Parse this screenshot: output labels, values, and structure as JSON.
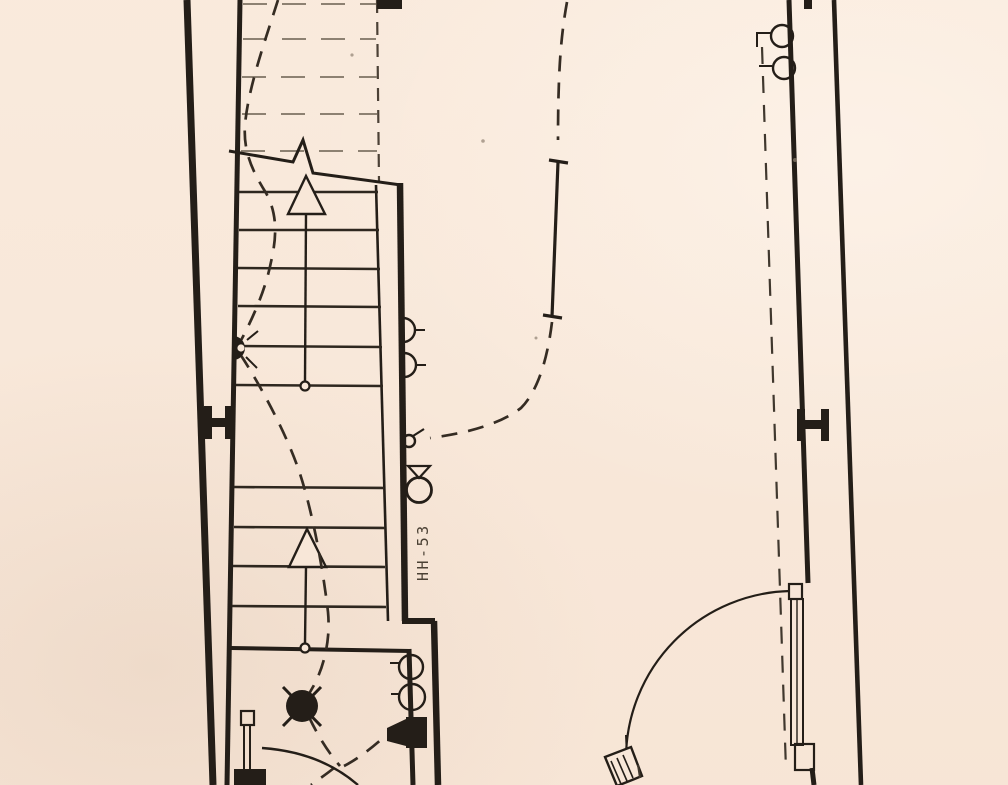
{
  "plan": {
    "kind": "scanned electrical floor plan - stairwell section",
    "riser_label": "HH-53",
    "colors": {
      "paper": "#f8e7d8",
      "ink": "#241e18",
      "faded_tread": "#8d8172",
      "wiring_dash": "#352c23",
      "label_ink": "#4a4034"
    },
    "symbols": [
      "stair-up-arrow",
      "stair-break-line",
      "wall-sconce-light",
      "crossed-ceiling-light",
      "wall-projector-fixture",
      "duplex-outlet",
      "junction-circle",
      "detector-circle-with-triangle",
      "steel-column-ibeam",
      "door-swing-arc",
      "conduit-home-run"
    ]
  }
}
